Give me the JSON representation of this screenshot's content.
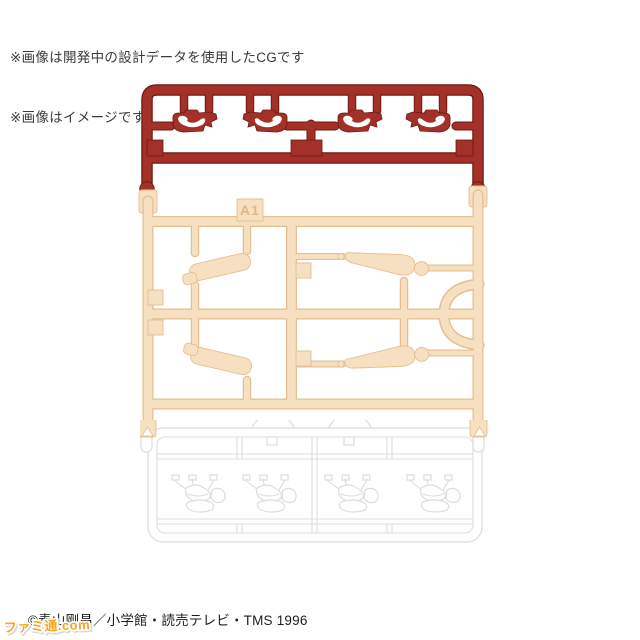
{
  "notes": {
    "line1": "※画像は開発中の設計データを使用したCGです",
    "line2": "※画像はイメージです"
  },
  "runner": {
    "cream_tag": "A1"
  },
  "footer": {
    "copyright": "©青山剛昌／小学館・読売テレビ・TMS 1996"
  },
  "watermark": {
    "text": "ファミ通.com"
  },
  "colors": {
    "red_main": "#a33029",
    "red_dark": "#701812",
    "cream_main": "#f7e0c1",
    "cream_edge": "#e4bf92",
    "cream_text": "#dfb686",
    "white_edge": "#dcdce2",
    "note_text": "#3a3a3a",
    "copyright_text": "#1c1c1c",
    "logo_orange": "#f8a51b"
  }
}
